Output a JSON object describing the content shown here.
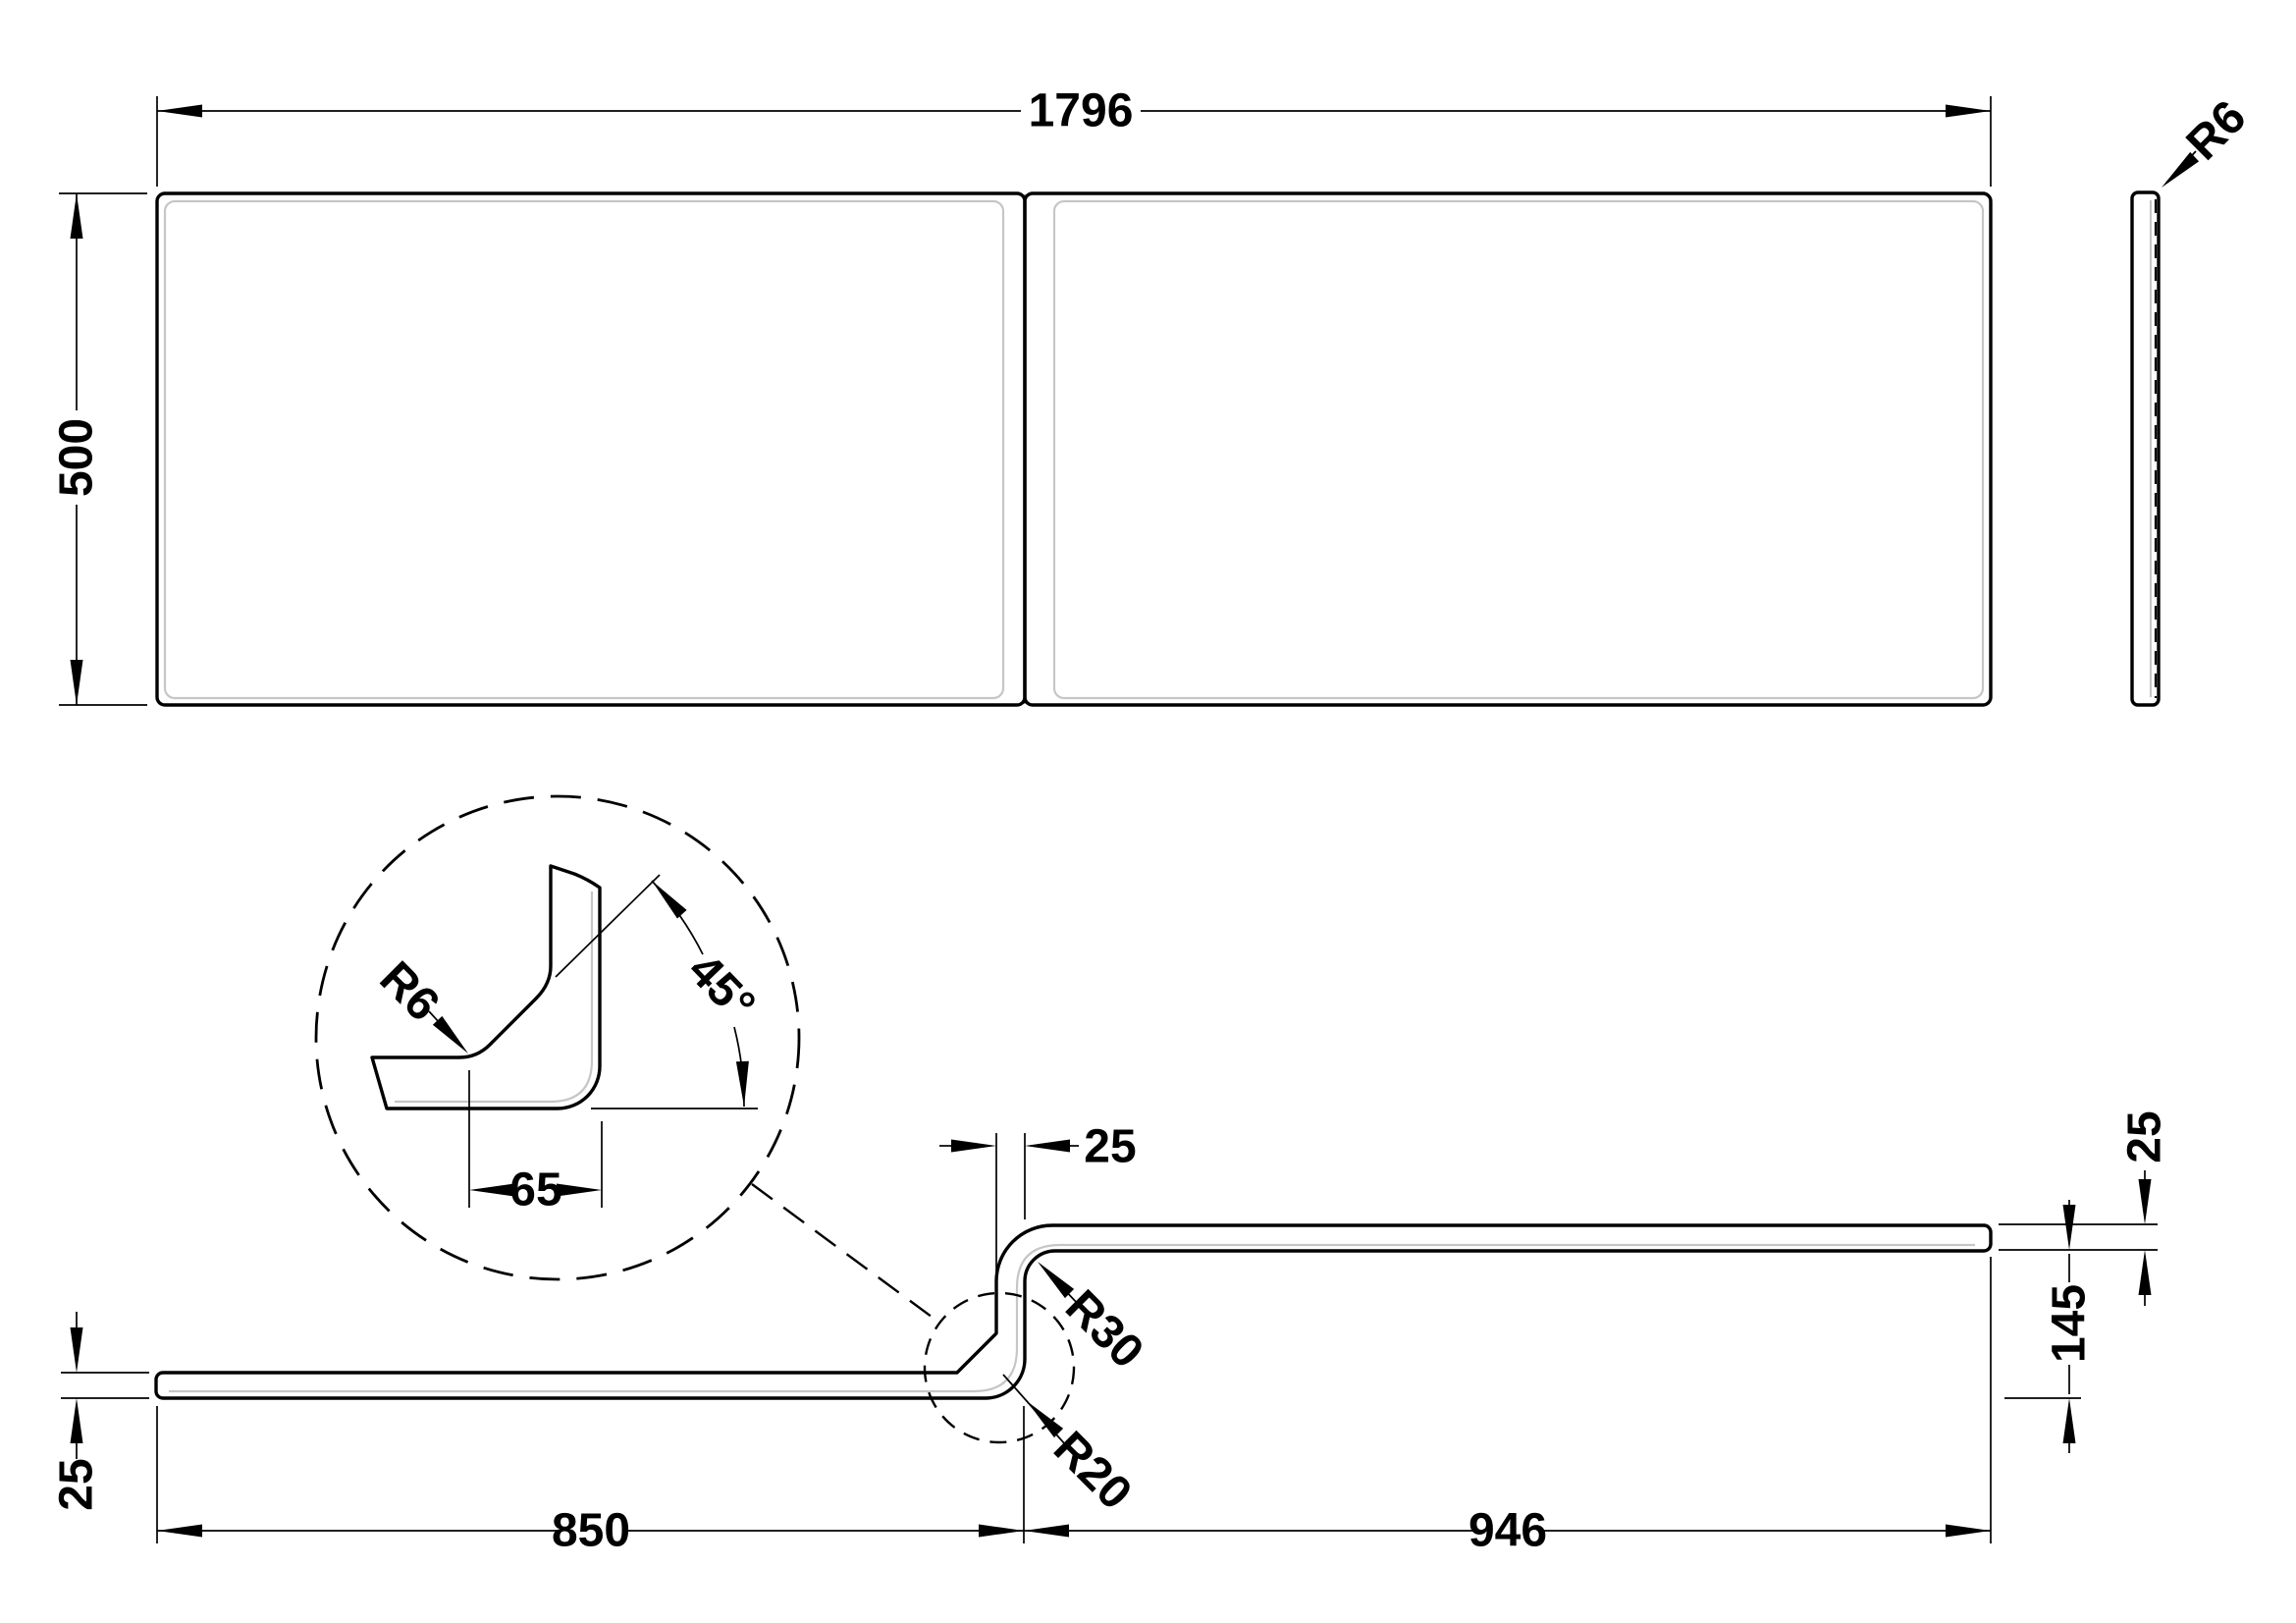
{
  "drawing": {
    "background_color": "#ffffff",
    "line_color": "#000000",
    "shade_color": "#c6c6c6"
  },
  "front_view": {
    "width": "1796",
    "height": "500"
  },
  "side_view": {
    "edge_radius": "R6"
  },
  "plan_view": {
    "left_section_length": "850",
    "right_section_length": "946",
    "left_thickness": "25",
    "bend_width": "25",
    "right_thickness": "25",
    "offset_depth": "145",
    "upper_bend_radius": "R30",
    "lower_bend_radius": "R20"
  },
  "detail_view": {
    "corner_radius": "R6",
    "chamfer_angle": "45°",
    "flange_width": "65"
  }
}
